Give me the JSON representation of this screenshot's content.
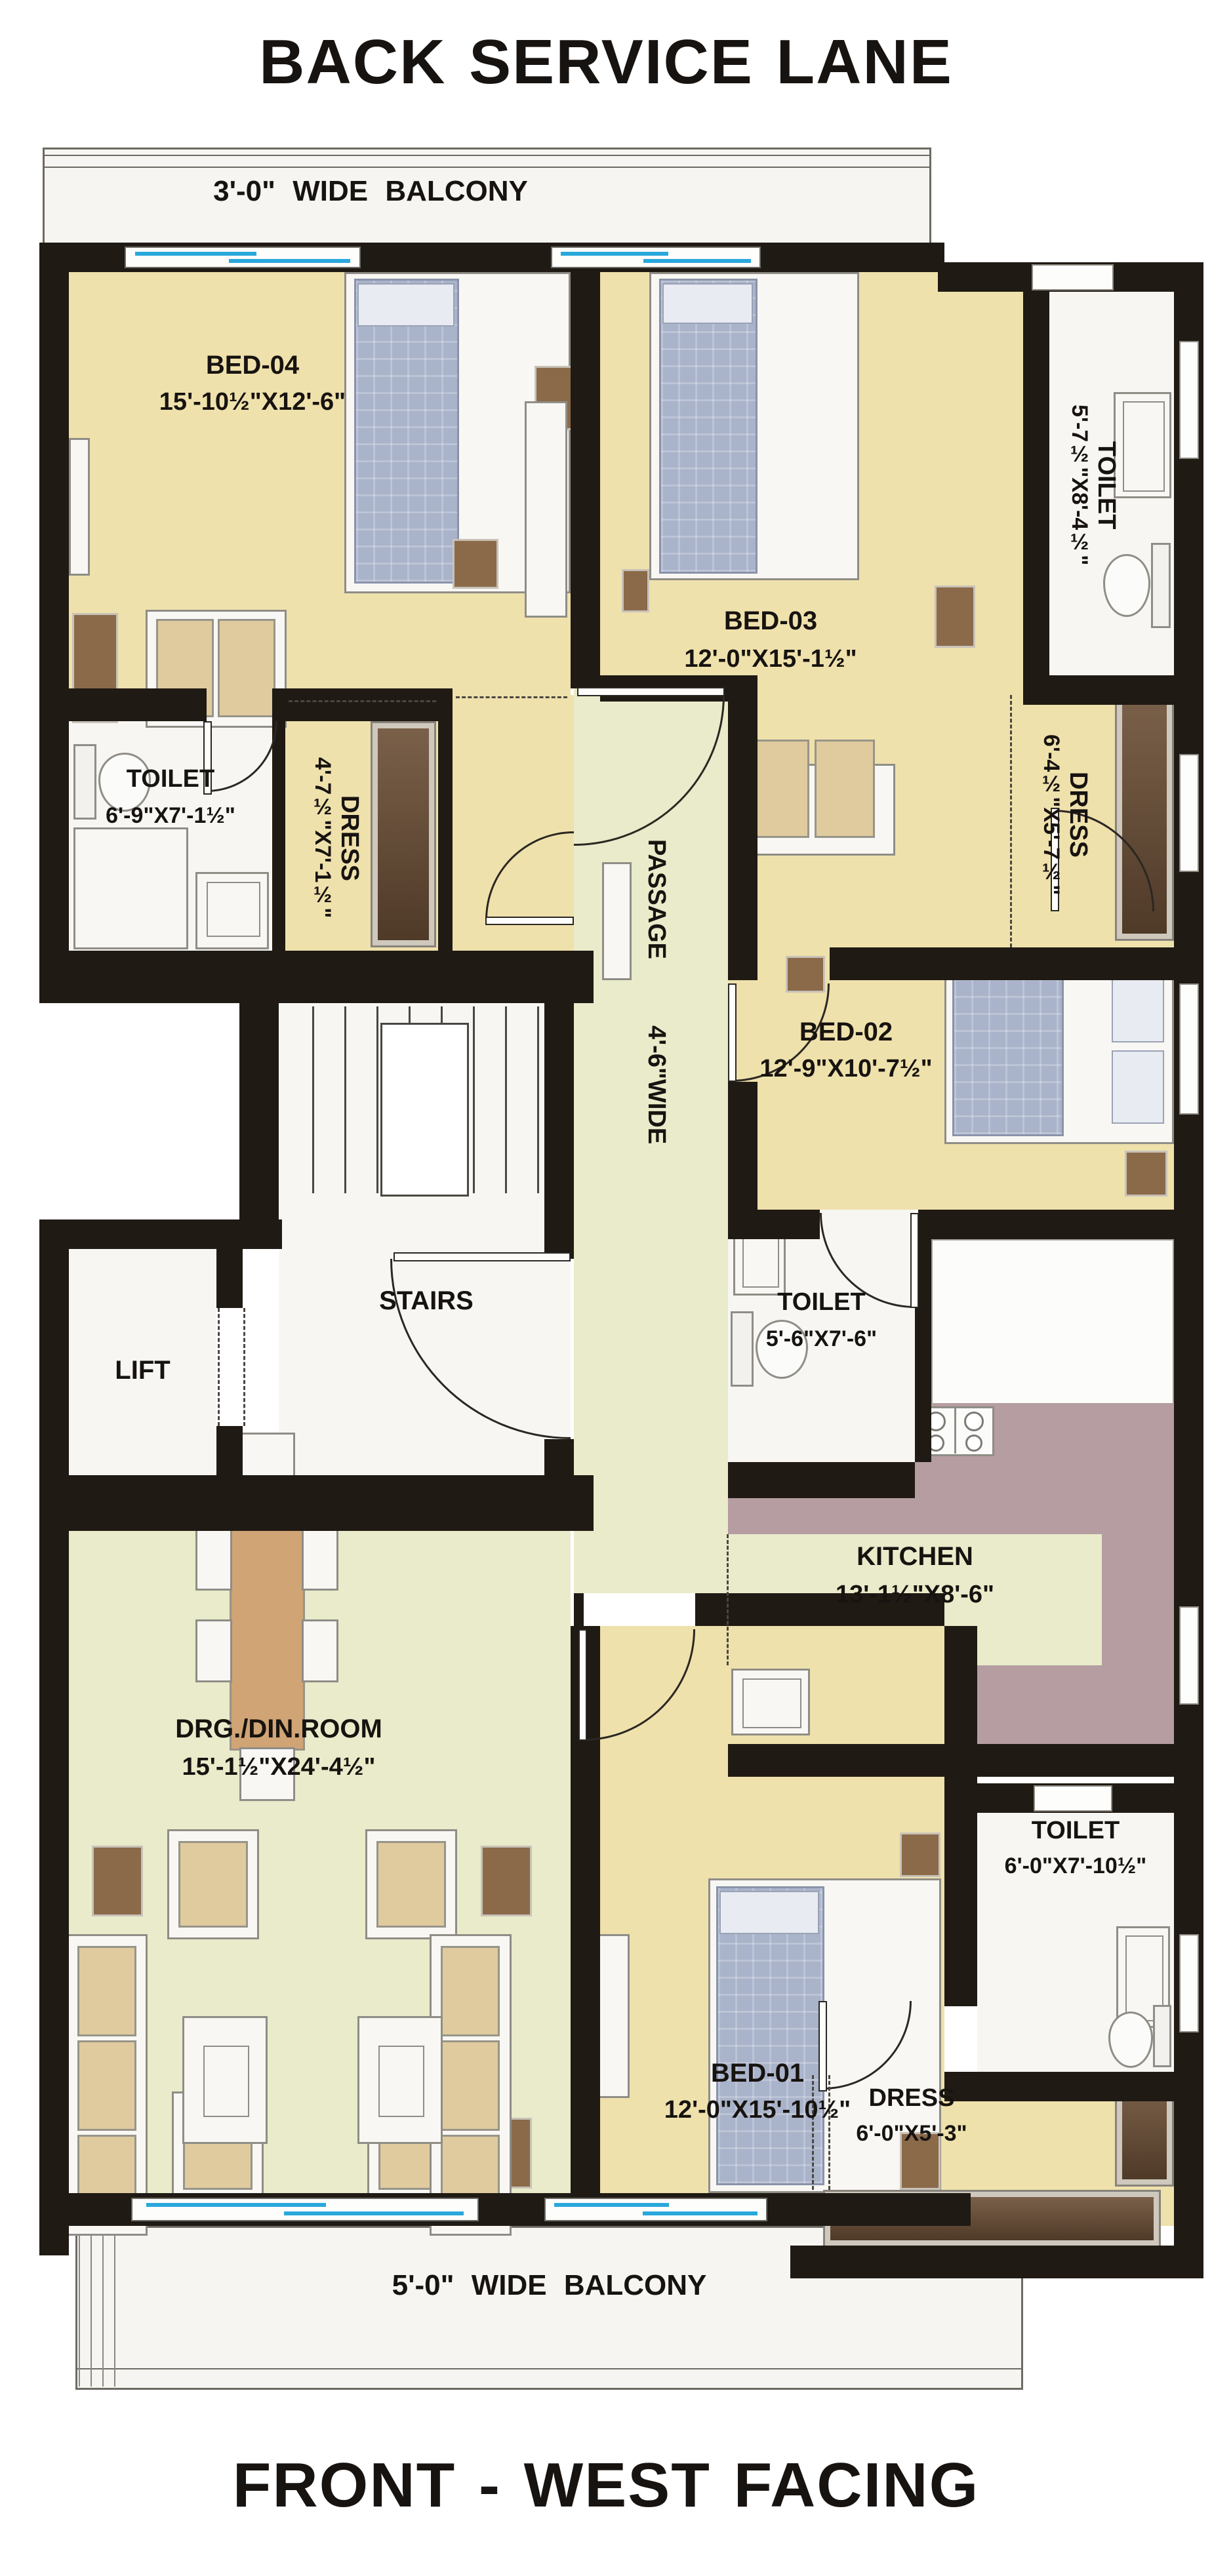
{
  "titles": {
    "back": "BACK SERVICE LANE",
    "front": "FRONT - WEST FACING"
  },
  "balconies": {
    "top": "3'-0\" WIDE BALCONY",
    "bottom": "5'-0\" WIDE BALCONY"
  },
  "rooms": {
    "bed04": {
      "name": "BED-04",
      "dims": "15'-10½\"X12'-6\""
    },
    "bed03": {
      "name": "BED-03",
      "dims": "12'-0\"X15'-1½\""
    },
    "bed02": {
      "name": "BED-02",
      "dims": "12'-9\"X10'-7½\""
    },
    "bed01": {
      "name": "BED-01",
      "dims": "12'-0\"X15'-10½\""
    },
    "toilet_top": {
      "name": "TOILET",
      "dims": "5'-7½\"X8'-4½\""
    },
    "dress_top": {
      "name": "DRESS",
      "dims": "6'-4½\"X5'-7½\""
    },
    "toilet_left": {
      "name": "TOILET",
      "dims": "6'-9\"X7'-1½\""
    },
    "dress_left": {
      "name": "DRESS",
      "dims": "4'-7½\"X7'-1½\""
    },
    "toilet_mid": {
      "name": "TOILET",
      "dims": "5'-6\"X7'-6\""
    },
    "toilet_bottom": {
      "name": "TOILET",
      "dims": "6'-0\"X7'-10½\""
    },
    "dress_bottom": {
      "name": "DRESS",
      "dims": "6'-0\"X5'-3\""
    },
    "kitchen": {
      "name": "KITCHEN",
      "dims": "13'-1½\"X8'-6\""
    },
    "drg": {
      "name": "DRG./DIN.ROOM",
      "dims": "15'-1½\"X24'-4½\""
    },
    "passage": {
      "name": "PASSAGE",
      "dims": "4'-6\"WIDE"
    },
    "stairs": {
      "name": "STAIRS"
    },
    "lift": {
      "name": "LIFT"
    }
  },
  "colors": {
    "wall": "#201a14",
    "bedroom_floor": "#efe1ac",
    "living_floor": "#e9ebca",
    "kitchen_counter": "#b59da1",
    "window_glass": "#29a8dc",
    "wardrobe": "#5f4632",
    "accent_brown": "#8b6a4a"
  }
}
